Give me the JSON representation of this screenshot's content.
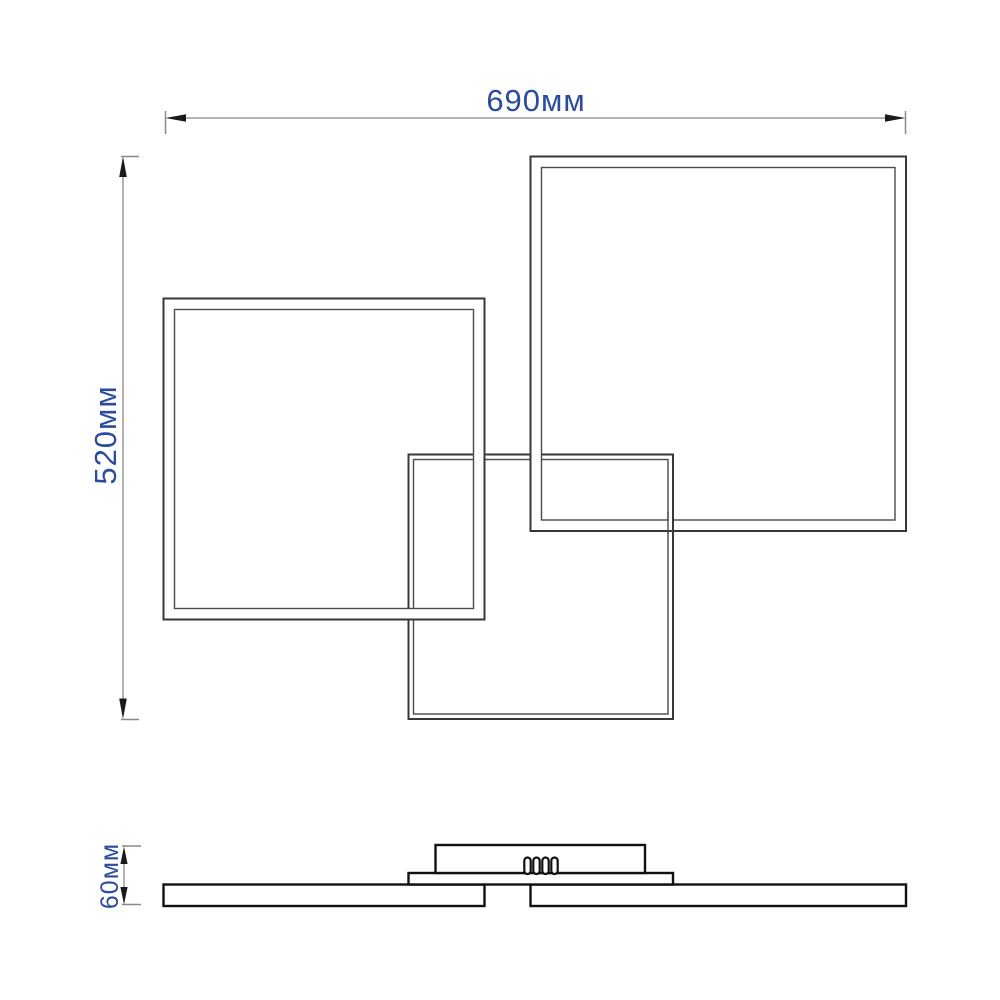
{
  "page": {
    "background": "#ffffff"
  },
  "labels": {
    "width": "690мм",
    "height": "520мм",
    "thickness": "60мм"
  },
  "colors": {
    "label_text": "#2b4b9e",
    "dimension_line": "#9b9b9b",
    "tick_line": "#8a8a8a",
    "arrowhead": "#1a1a1a",
    "frame_outer_line": "#383838",
    "frame_inner_line": "#4a4a4a",
    "profile_line": "#111111",
    "white_fill": "#ffffff"
  }
}
